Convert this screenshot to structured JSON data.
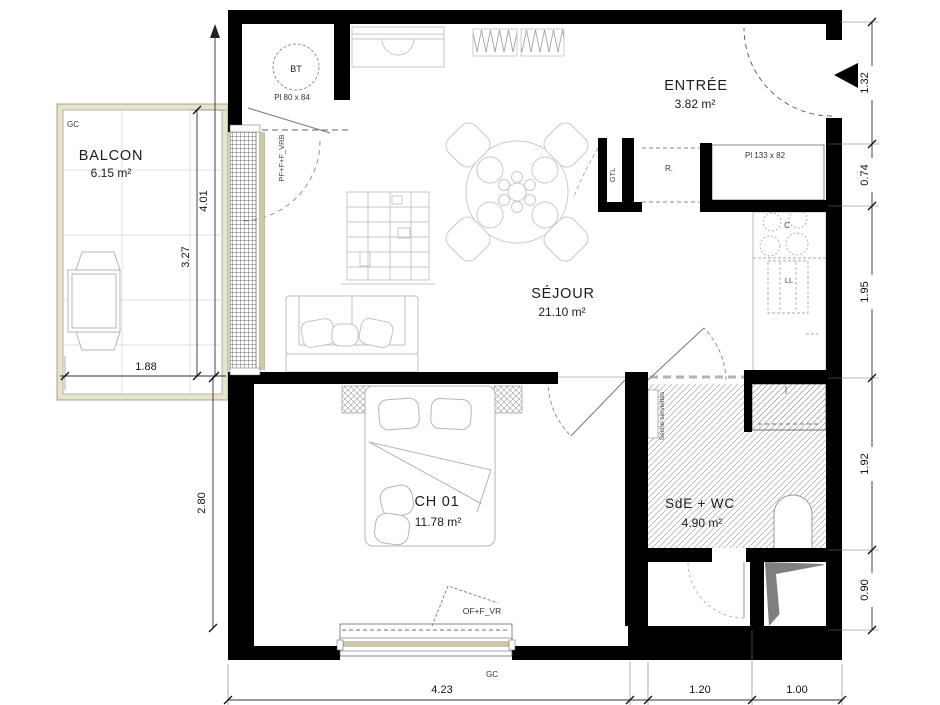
{
  "plan": {
    "type": "apartment-floor-plan",
    "colors": {
      "wall": "#000000",
      "furniture_stroke": "#bdbdbd",
      "dimension_stroke": "#333333",
      "balcony_frame": "#e6e3cf",
      "balcony_frame_edge": "#96926f",
      "window_band": "#cfc9a6",
      "hatch": "#a8a8a8",
      "shaft_gray": "#7f7f7f"
    }
  },
  "rooms": {
    "balcon": {
      "name": "BALCON",
      "area": "6.15 m²"
    },
    "entree": {
      "name": "ENTRÉE",
      "area": "3.82 m²"
    },
    "sejour": {
      "name": "SÉJOUR",
      "area": "21.10 m²"
    },
    "ch01": {
      "name": "CH 01",
      "area": "11.78 m²"
    },
    "sde": {
      "name": "SdE + WC",
      "area": "4.90 m²"
    }
  },
  "annotations": {
    "gc_balcony": "GC",
    "gc_window": "GC",
    "bt": "BT",
    "bt_placard": "Pl 80 x 84",
    "entry_placard": "Pl 133 x 82",
    "gtl": "GTL",
    "r": "R.",
    "cooktop": "C",
    "washer": "LL",
    "towel_dryer": "Sèche-serviettes",
    "balcony_door_type": "PF+F+F_VRB",
    "bedroom_window_type": "OF+F_VR"
  },
  "dimensions": {
    "right": [
      "1.32",
      "0.74",
      "1.95",
      "1.92",
      "0.90"
    ],
    "left_side": [
      "4.01",
      "3.27",
      "2.80"
    ],
    "balcony_width": "1.88",
    "bottom": [
      "4.23",
      "1.20",
      "1.00"
    ]
  }
}
